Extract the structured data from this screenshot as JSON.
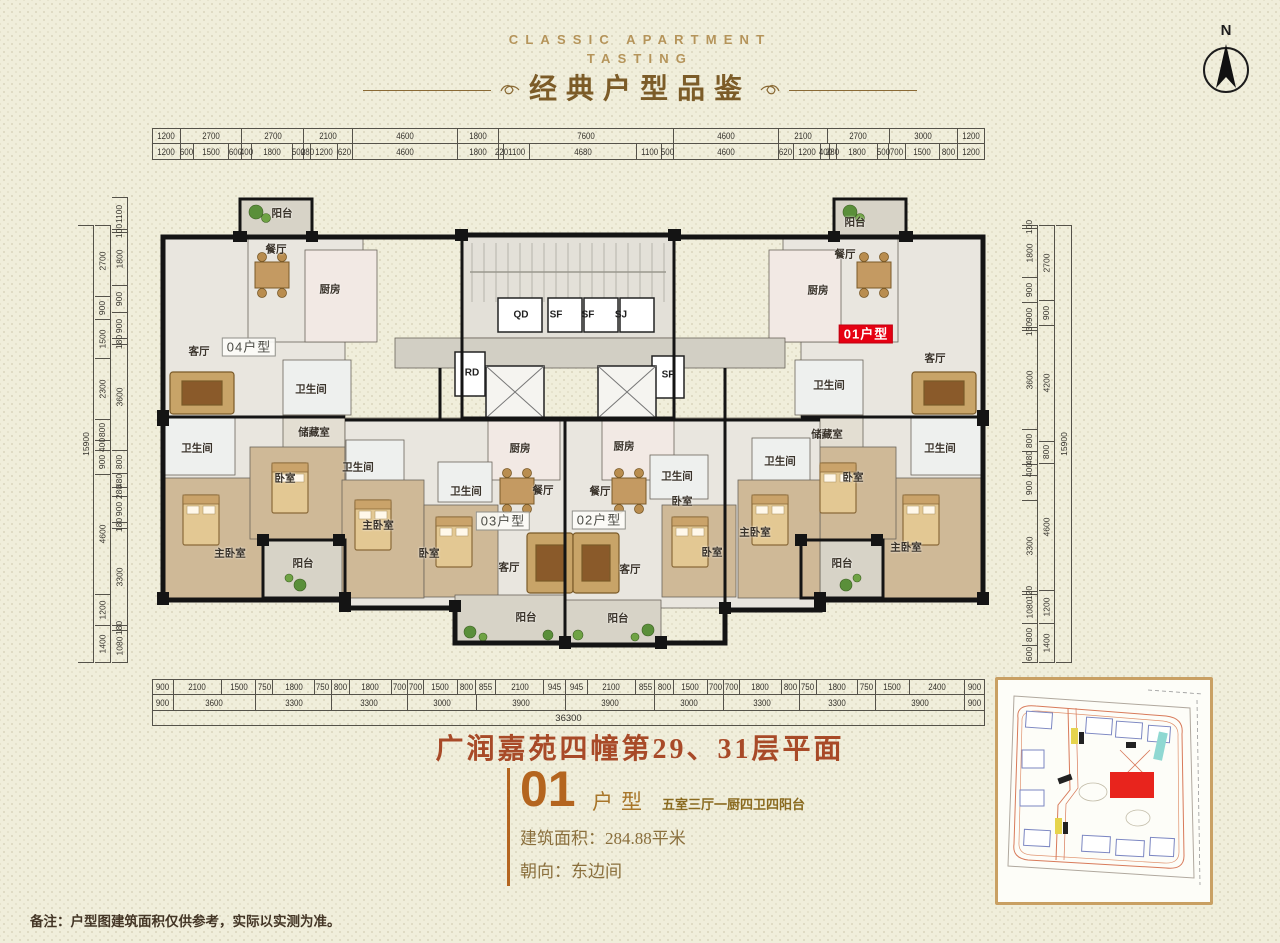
{
  "header": {
    "eyebrow_line1": "CLASSIC APARTMENT",
    "eyebrow_line2": "TASTING",
    "title": "经典户型品鉴"
  },
  "compass": {
    "label": "N"
  },
  "dimensions": {
    "top_row1": [
      1200,
      2700,
      2700,
      2100,
      4600,
      1800,
      7600,
      4600,
      2100,
      2700,
      3000,
      1200
    ],
    "top_row2": [
      1200,
      600,
      1500,
      600,
      400,
      1800,
      500,
      280,
      1200,
      620,
      4600,
      1800,
      220,
      1100,
      4680,
      1100,
      500,
      4600,
      620,
      1200,
      400,
      280,
      1800,
      500,
      700,
      1500,
      800,
      1200
    ],
    "bottom_row1": [
      900,
      2100,
      1500,
      750,
      1800,
      750,
      800,
      1800,
      700,
      700,
      1500,
      800,
      855,
      2100,
      945,
      945,
      2100,
      855,
      800,
      1500,
      700,
      700,
      1800,
      800,
      750,
      1800,
      750,
      1500,
      2400,
      900
    ],
    "bottom_row2": [
      900,
      3600,
      3300,
      3300,
      3000,
      3900,
      3900,
      3000,
      3300,
      3300,
      3900,
      900
    ],
    "bottom_total": "36300",
    "left_outer": [
      15900
    ],
    "left_mid": [
      2700,
      900,
      1500,
      2300,
      800,
      400,
      900,
      4600,
      1200,
      1400
    ],
    "left_inner": [
      1100,
      100,
      1800,
      900,
      900,
      180,
      3600,
      800,
      480,
      280,
      900,
      180,
      3300,
      180,
      1080
    ],
    "right_outer": [
      15900
    ],
    "right_mid": [
      2700,
      900,
      4200,
      800,
      4600,
      1200,
      1400
    ],
    "right_inner": [
      100,
      1800,
      900,
      900,
      130,
      3600,
      800,
      480,
      400,
      900,
      3300,
      120,
      1080,
      800,
      600
    ]
  },
  "floorplan": {
    "unit_labels": [
      {
        "text": "04户型",
        "x": 249,
        "y": 347,
        "style": "box"
      },
      {
        "text": "03户型",
        "x": 503,
        "y": 521,
        "style": "box"
      },
      {
        "text": "02户型",
        "x": 599,
        "y": 520,
        "style": "box"
      },
      {
        "text": "01户型",
        "x": 866,
        "y": 334,
        "style": "red"
      }
    ],
    "rooms": [
      {
        "label": "阳台",
        "x": 282,
        "y": 213
      },
      {
        "label": "餐厅",
        "x": 276,
        "y": 249
      },
      {
        "label": "厨房",
        "x": 330,
        "y": 289
      },
      {
        "label": "客厅",
        "x": 199,
        "y": 351
      },
      {
        "label": "卫生间",
        "x": 311,
        "y": 389
      },
      {
        "label": "储藏室",
        "x": 314,
        "y": 432
      },
      {
        "label": "卫生间",
        "x": 197,
        "y": 448
      },
      {
        "label": "卧室",
        "x": 285,
        "y": 478
      },
      {
        "label": "主卧室",
        "x": 230,
        "y": 553
      },
      {
        "label": "阳台",
        "x": 303,
        "y": 563
      },
      {
        "label": "卫生间",
        "x": 358,
        "y": 467
      },
      {
        "label": "主卧室",
        "x": 378,
        "y": 525
      },
      {
        "label": "卧室",
        "x": 429,
        "y": 553
      },
      {
        "label": "卫生间",
        "x": 466,
        "y": 491
      },
      {
        "label": "厨房",
        "x": 520,
        "y": 448
      },
      {
        "label": "餐厅",
        "x": 543,
        "y": 490
      },
      {
        "label": "客厅",
        "x": 509,
        "y": 567
      },
      {
        "label": "阳台",
        "x": 526,
        "y": 617
      },
      {
        "label": "厨房",
        "x": 624,
        "y": 446
      },
      {
        "label": "餐厅",
        "x": 600,
        "y": 491
      },
      {
        "label": "卫生间",
        "x": 677,
        "y": 476
      },
      {
        "label": "卧室",
        "x": 682,
        "y": 501
      },
      {
        "label": "客厅",
        "x": 630,
        "y": 569
      },
      {
        "label": "阳台",
        "x": 618,
        "y": 618
      },
      {
        "label": "卧室",
        "x": 712,
        "y": 552
      },
      {
        "label": "主卧室",
        "x": 755,
        "y": 532
      },
      {
        "label": "卫生间",
        "x": 780,
        "y": 461
      },
      {
        "label": "阳台",
        "x": 855,
        "y": 222
      },
      {
        "label": "餐厅",
        "x": 845,
        "y": 254
      },
      {
        "label": "厨房",
        "x": 818,
        "y": 290
      },
      {
        "label": "客厅",
        "x": 935,
        "y": 358
      },
      {
        "label": "卫生间",
        "x": 829,
        "y": 385
      },
      {
        "label": "储藏室",
        "x": 827,
        "y": 434
      },
      {
        "label": "卧室",
        "x": 853,
        "y": 477
      },
      {
        "label": "卫生间",
        "x": 940,
        "y": 448
      },
      {
        "label": "主卧室",
        "x": 906,
        "y": 547
      },
      {
        "label": "阳台",
        "x": 842,
        "y": 563
      }
    ],
    "core_labels": [
      {
        "label": "QD",
        "x": 521,
        "y": 315
      },
      {
        "label": "SF",
        "x": 556,
        "y": 315
      },
      {
        "label": "SF",
        "x": 588,
        "y": 315
      },
      {
        "label": "SJ",
        "x": 621,
        "y": 315
      },
      {
        "label": "RD",
        "x": 472,
        "y": 373
      },
      {
        "label": "SF",
        "x": 668,
        "y": 375
      }
    ]
  },
  "title_block": {
    "plan_title": "广润嘉苑四幢第29、31层平面",
    "unit_number": "01",
    "unit_word": "户型",
    "unit_desc": "五室三厅一厨四卫四阳台",
    "area_line": "建筑面积：284.88平米",
    "facing_line": "朝向：东边间"
  },
  "note": "备注：户型图建筑面积仅供参考，实际以实测为准。",
  "colors": {
    "background": "#f0eedb",
    "accent_red": "#e60012",
    "header_gold": "#b5945a",
    "title_brown": "#7c5c28",
    "plan_title_rust": "#a84a28",
    "unit_orange": "#b4651f",
    "wall_black": "#141414",
    "site_map_border": "#c9a063"
  }
}
